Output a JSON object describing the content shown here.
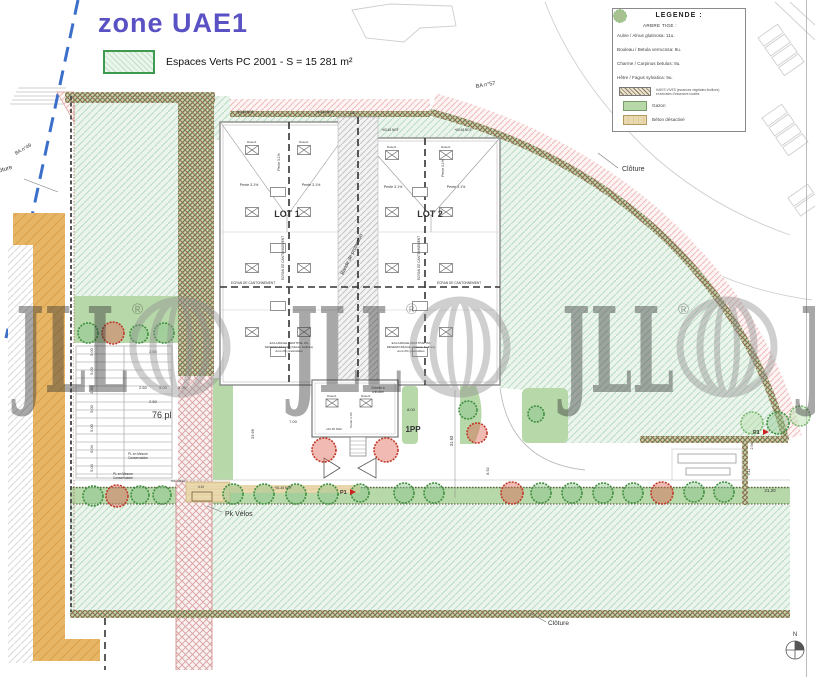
{
  "title": "zone UAE1",
  "green_legend": {
    "label": "Espaces Verts PC 2001 - S = 15 281 m²"
  },
  "legend": {
    "title": "LEGENDE :",
    "section": "ARBRE TIGE :",
    "trees": [
      {
        "name": "aulne",
        "label": "Aulne / Alnus glutinosa: 11u.",
        "color": "#55a055"
      },
      {
        "name": "bouleau",
        "label": "Bouleau / Betula verrucosa: 8u.",
        "color": "#cc4433"
      },
      {
        "name": "charme",
        "label": "Charme / Carpinus betulus: 8u.",
        "color": "#3d8a3d"
      },
      {
        "name": "hetre",
        "label": "Hêtre / Fagus sylvatica: 9u.",
        "color": "#9ccc8e"
      }
    ],
    "hedge_label": "HAIES VIVES (essences végétales feuillues)",
    "hedge_sublabel": "et arbustes d'essences locales",
    "gazon_label": "Gazon",
    "beton_label": "Béton désactivé"
  },
  "labels": {
    "lot1": "LOT 1",
    "lot2": "LOT 2",
    "cloture": "Clôture",
    "ba57": "BA n°57",
    "ba49": "BA n°49",
    "pk_velos": "Pk Vélos",
    "parking_count": "76 pl",
    "pp": "1PP",
    "pente": "Pente 3.1%",
    "ecran": "ECRAN DE CANTONNEMENT",
    "bande_protection": "Bande de protection",
    "eclairage_1": "ECLAIRAGE ZENITHAL 4%",
    "eclairage_2": "DESENFUMAGE (châssis fusibles)",
    "eclairage_3": "dont 2% praticables",
    "ngf_roof": "+63.48 NGF",
    "ngf_small": "+62.45 NGF",
    "ngf_ground": "+61.45 NGF",
    "pl_mesure_1": "PL en Mesure",
    "pl_mesure_2": "Conservatoire",
    "tdl_cables": "TDL câbles",
    "echelle_1": "Echelle à",
    "echelle_2": "crinoline",
    "desenf": "Désenf.",
    "p1": "P1",
    "north": "N"
  },
  "dims": {
    "d250": "2.50",
    "d500": "5.00",
    "d700": "7.00",
    "d800": "8.00",
    "d892": "8.92",
    "d3193": "31.93",
    "d3366": "33.66",
    "d2120": "21.20",
    "d611": "6.11",
    "d294": "2.94",
    "d410": "4.10",
    "d18": "1.8",
    "left_chain": [
      "5.00",
      "5.00",
      "2.50",
      "5.00",
      "5.00",
      "6.04",
      "5.04"
    ],
    "top_row": [
      "2.50",
      "5.00",
      "5.00"
    ]
  },
  "watermark": {
    "text": "JLL",
    "reg": "®"
  },
  "colors": {
    "title": "#5a52c4",
    "espaces_verts": "#bfe0c6",
    "gazon": "#b7d8a9",
    "beton": "#ead9ae",
    "tree_green": "#4e9e4e",
    "tree_red": "#c0392b",
    "tree_light": "#9ccc8e",
    "boundary_blue": "#3b6fc9",
    "watermark": "#8f8f8f"
  }
}
